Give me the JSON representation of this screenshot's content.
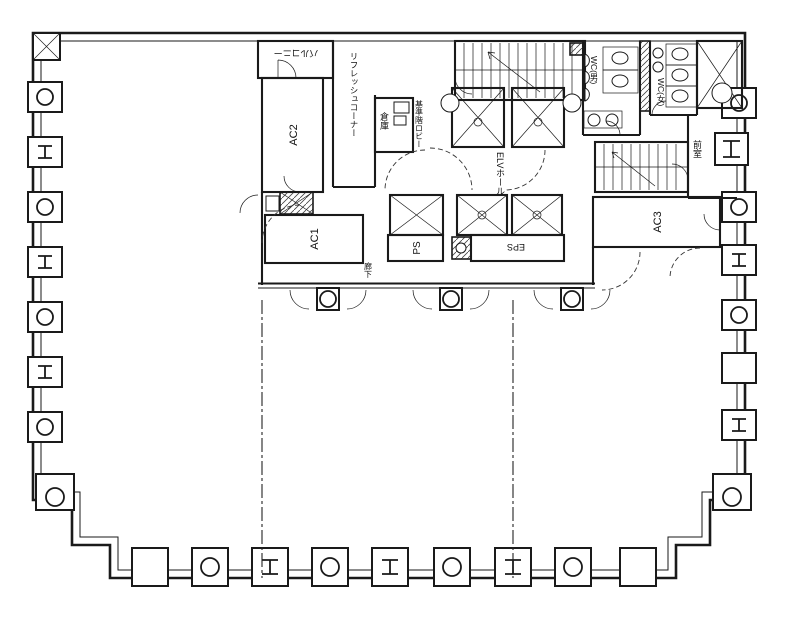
{
  "drawing": {
    "type": "architectural-floor-plan",
    "ink_color": "#1a1a1a",
    "paper_color": "#ffffff"
  },
  "labels": {
    "balcony": "バルコニー",
    "ac2": "AC2",
    "refresh_corner": "リフレッシュコーナー",
    "storage": "倉庫",
    "main_lobby": "基準階ロビー",
    "elv_hall": "ELVホール",
    "wc_men": "WC(男)",
    "wc_women": "WC(女)",
    "anteroom": "前室",
    "ac1": "AC1",
    "ac3": "AC3",
    "ps": "PS",
    "eps": "EPS",
    "corridor": "廊下"
  }
}
